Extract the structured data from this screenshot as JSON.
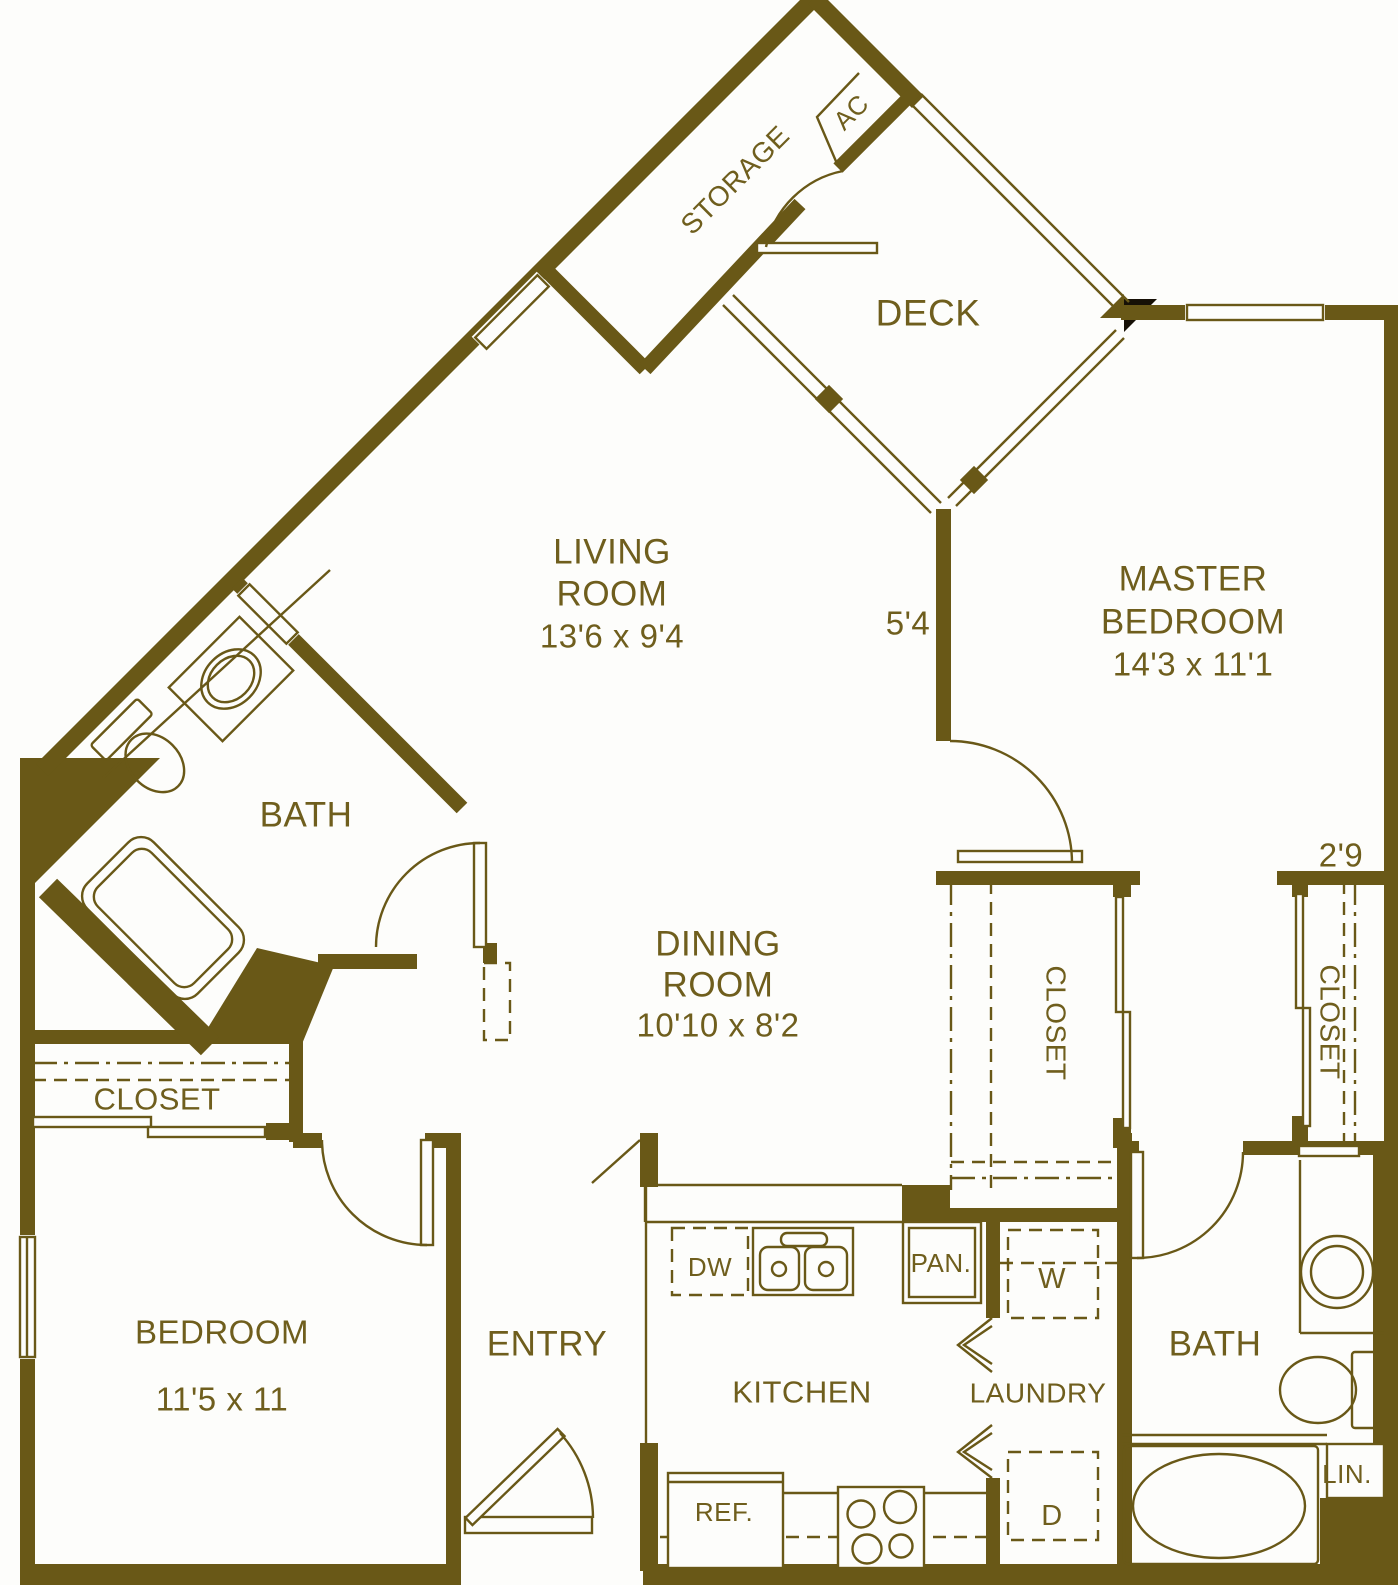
{
  "colors": {
    "wall": "#695817",
    "text": "#6f5e1d",
    "background": "#fdfdfb",
    "corner_accent": "#161006"
  },
  "rooms": [
    {
      "id": "storage",
      "label": "STORAGE"
    },
    {
      "id": "ac-unit",
      "label": "AC"
    },
    {
      "id": "deck",
      "label": "DECK"
    },
    {
      "id": "living-room",
      "line1": "LIVING",
      "line2": "ROOM",
      "dims": "13'6 x 9'4"
    },
    {
      "id": "master-bedroom",
      "line1": "MASTER",
      "line2": "BEDROOM",
      "dims": "14'3 x 11'1"
    },
    {
      "id": "bath-upper",
      "label": "BATH"
    },
    {
      "id": "dining-room",
      "line1": "DINING",
      "line2": "ROOM",
      "dims": "10'10 x 8'2"
    },
    {
      "id": "closet-hall",
      "label": "CLOSET"
    },
    {
      "id": "closet-master",
      "label": "CLOSET"
    },
    {
      "id": "closet-bedroom",
      "label": "CLOSET"
    },
    {
      "id": "bedroom",
      "line1": "BEDROOM",
      "dims": "11'5 x 11"
    },
    {
      "id": "entry",
      "label": "ENTRY"
    },
    {
      "id": "kitchen",
      "label": "KITCHEN"
    },
    {
      "id": "laundry",
      "label": "LAUNDRY"
    },
    {
      "id": "bath-lower",
      "label": "BATH"
    }
  ],
  "annotations": {
    "deck_wall_length": "5'4",
    "master_closet_depth": "2'9"
  },
  "fixtures": {
    "dishwasher": "DW",
    "pantry": "PAN.",
    "washer": "W",
    "dryer": "D",
    "refrigerator": "REF.",
    "linen": "LIN."
  }
}
